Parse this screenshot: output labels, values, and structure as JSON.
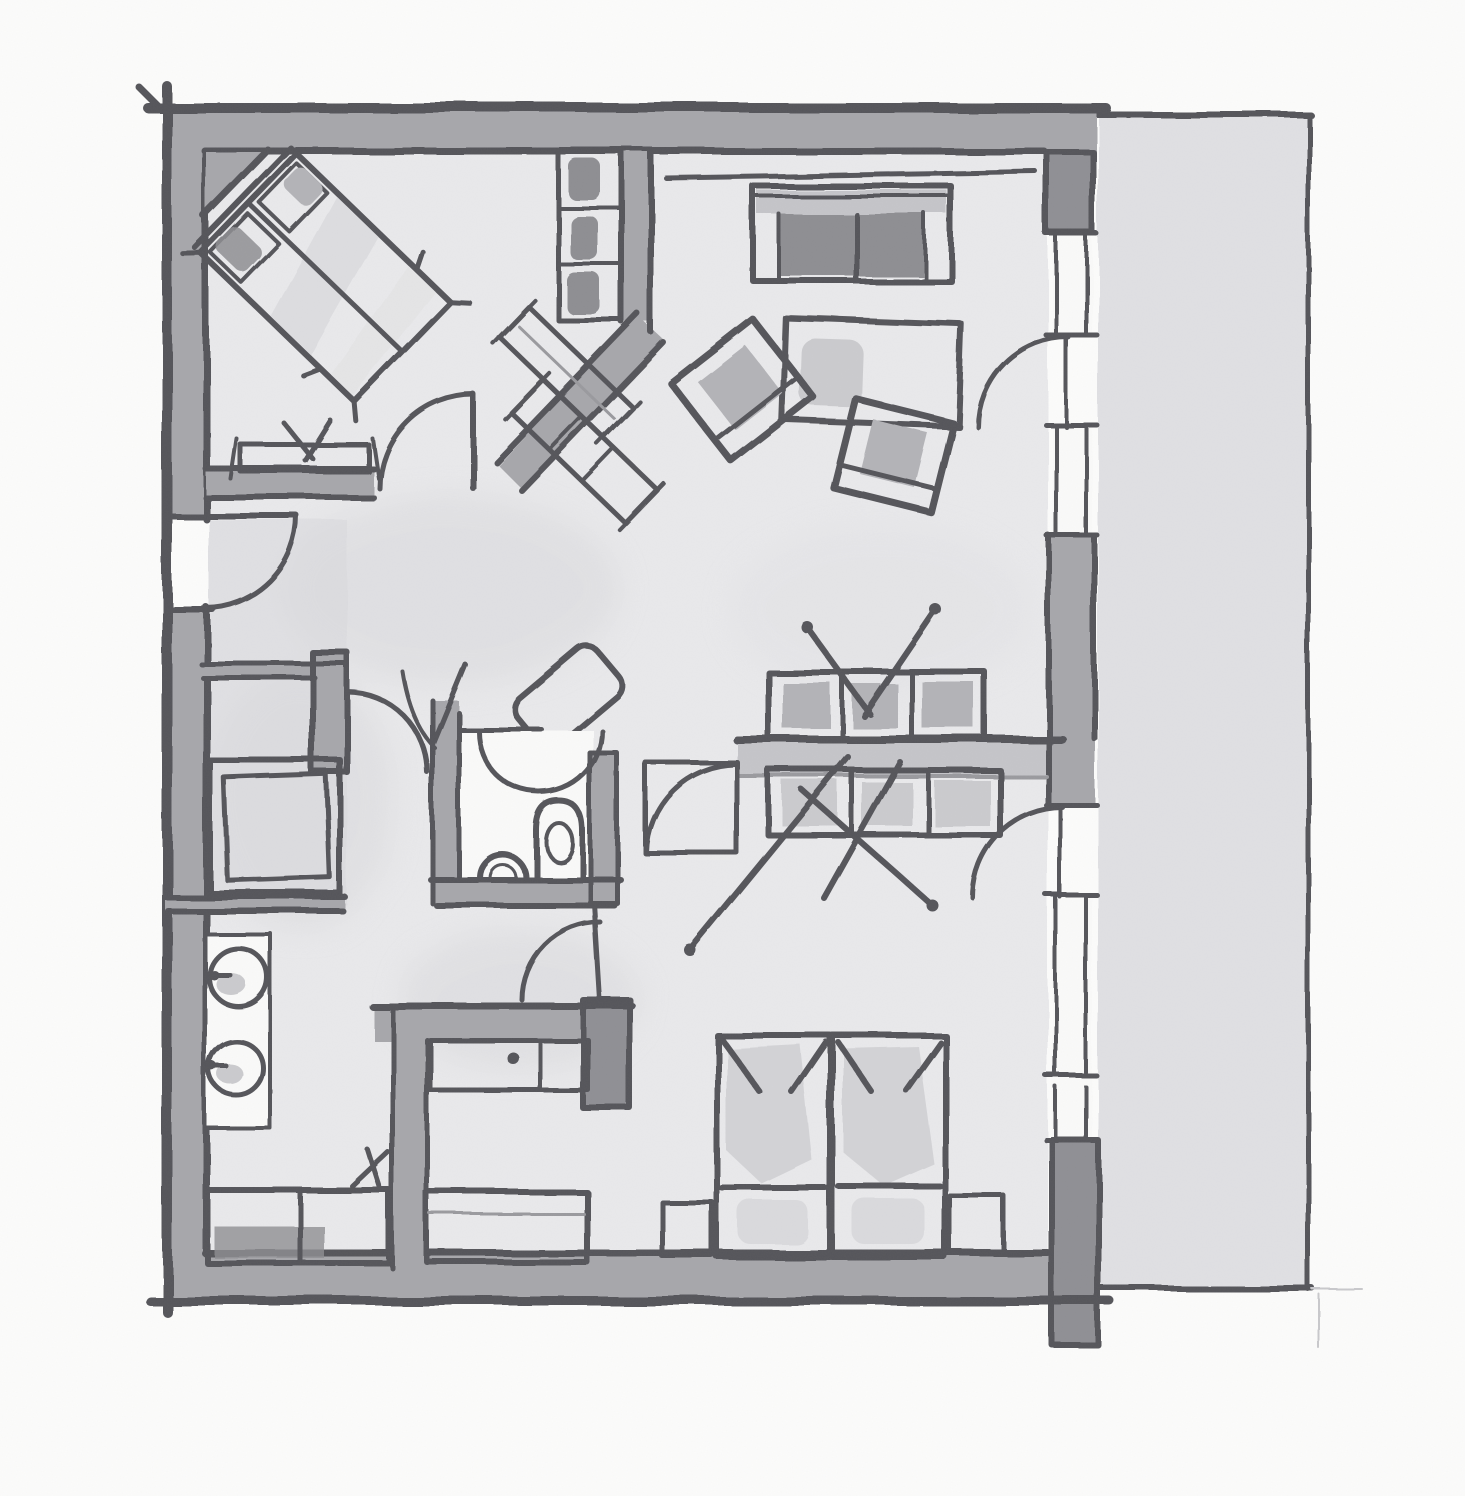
{
  "figure": {
    "title": "Hand-drawn apartment floor plan sketch (ink and watercolor, top-down view)",
    "type": "floor-plan",
    "medium": "ink-and-watercolor"
  },
  "palette": {
    "paper": "#fcfcfb",
    "floor": "#e9e9eb",
    "terrace": "#e0e0e3",
    "wash": "#d9d9dc",
    "wall": "#a7a7ab",
    "wallLight": "#c5c5c9",
    "wallDark": "#8f8f94",
    "ink": "#55555a",
    "inkSoft": "#9a9a9e",
    "furn": "#b3b3b7",
    "furnDark": "#8e8e92",
    "furnLight": "#cbcbce",
    "white": "#fafaf9"
  },
  "rooms": [
    {
      "name": "bedroom-main",
      "position": "top-left",
      "furniture": [
        "double-bed-diagonal",
        "wardrobe-with-clothes",
        "dresser-diagonal",
        "sideboard",
        "door-swing"
      ]
    },
    {
      "name": "living-room",
      "position": "top-right",
      "furniture": [
        "sofa",
        "coffee-table",
        "armchair-left",
        "armchair-right",
        "terrace-door-swing"
      ]
    },
    {
      "name": "hallway",
      "position": "center-left",
      "furniture": [
        "entry-door-swing",
        "bench-diagonal",
        "tub-bench-diagonal"
      ]
    },
    {
      "name": "storage-room",
      "position": "middle-left",
      "furniture": [
        "large-cabinet",
        "door-swing"
      ]
    },
    {
      "name": "wc",
      "position": "center",
      "furniture": [
        "toilet",
        "washbasin",
        "door-swing"
      ]
    },
    {
      "name": "dressing-area",
      "position": "center-right",
      "furniture": [
        "wardrobe-top-row",
        "wardrobe-bottom-row",
        "hanger-marks",
        "door-leaf",
        "door-swing"
      ]
    },
    {
      "name": "kitchenette",
      "position": "bottom-left",
      "furniture": [
        "counter",
        "sink-circle",
        "cooktop-circle",
        "base-cabinet",
        "chair-mark"
      ]
    },
    {
      "name": "small-room",
      "position": "bottom-center",
      "furniture": [
        "shelf-counter",
        "bench"
      ]
    },
    {
      "name": "bedroom-second",
      "position": "bottom-right",
      "furniture": [
        "twin-bed-left",
        "twin-bed-right",
        "nightstand-left",
        "nightstand-right"
      ]
    },
    {
      "name": "terrace",
      "position": "right",
      "furniture": []
    }
  ],
  "windows": [
    "right-wall-upper",
    "right-wall-mid",
    "right-wall-lower"
  ],
  "doors": [
    "entry-left-wall",
    "bedroom-main",
    "living-to-terrace",
    "storage",
    "wc",
    "dressing-left",
    "dressing-right",
    "corridor",
    "bedroom-second-to-terrace"
  ]
}
